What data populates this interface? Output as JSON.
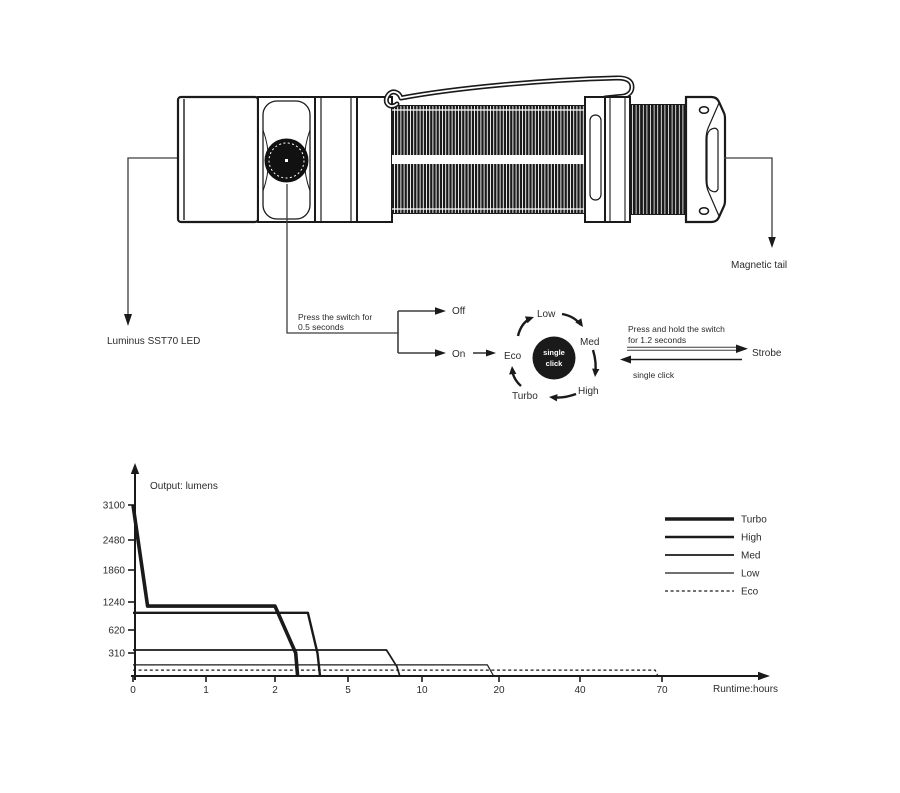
{
  "colors": {
    "ink": "#1a1a1a",
    "annotation": "#3d3d3d",
    "background": "#ffffff"
  },
  "flashlight": {
    "led_label": "Luminus SST70 LED",
    "magnetic_tail_label": "Magnetic tail"
  },
  "controls": {
    "press_note": [
      "Press the switch for",
      "0.5 seconds"
    ],
    "off_label": "Off",
    "on_label": "On",
    "cycle": {
      "center": [
        "single",
        "click"
      ],
      "eco": "Eco",
      "low": "Low",
      "med": "Med",
      "high": "High",
      "turbo": "Turbo"
    },
    "strobe_note": [
      "Press and hold the switch",
      "for 1.2 seconds"
    ],
    "strobe_label": "Strobe",
    "single_click_label": "single click"
  },
  "chart_data": {
    "type": "line",
    "title": "Output: lumens",
    "xlabel": "Runtime:hours",
    "x_ticks": [
      0,
      1,
      2,
      5,
      10,
      20,
      40,
      70
    ],
    "y_ticks": [
      310,
      620,
      1240,
      1860,
      2480,
      3100
    ],
    "axis_note": "non-linear axes, tick labels equally spaced",
    "grid": false,
    "legend_position": "right",
    "series": [
      {
        "name": "Turbo",
        "style": "solid",
        "weight": "xxthick",
        "points": [
          [
            0,
            3100
          ],
          [
            0.2,
            1150
          ],
          [
            2.0,
            1150
          ],
          [
            2.85,
            310
          ],
          [
            2.93,
            0
          ]
        ]
      },
      {
        "name": "High",
        "style": "solid",
        "weight": "thick",
        "points": [
          [
            0,
            1000
          ],
          [
            3.35,
            1000
          ],
          [
            3.75,
            300
          ],
          [
            3.85,
            0
          ]
        ]
      },
      {
        "name": "Med",
        "style": "solid",
        "weight": "medium",
        "points": [
          [
            0,
            350
          ],
          [
            7.6,
            350
          ],
          [
            8.3,
            130
          ],
          [
            8.5,
            0
          ]
        ]
      },
      {
        "name": "Low",
        "style": "solid",
        "weight": "thin",
        "points": [
          [
            0,
            150
          ],
          [
            18.5,
            150
          ],
          [
            19.3,
            0
          ]
        ]
      },
      {
        "name": "Eco",
        "style": "dashed",
        "weight": "thin",
        "points": [
          [
            0,
            80
          ],
          [
            67.5,
            80
          ],
          [
            68.5,
            0
          ]
        ]
      }
    ]
  }
}
